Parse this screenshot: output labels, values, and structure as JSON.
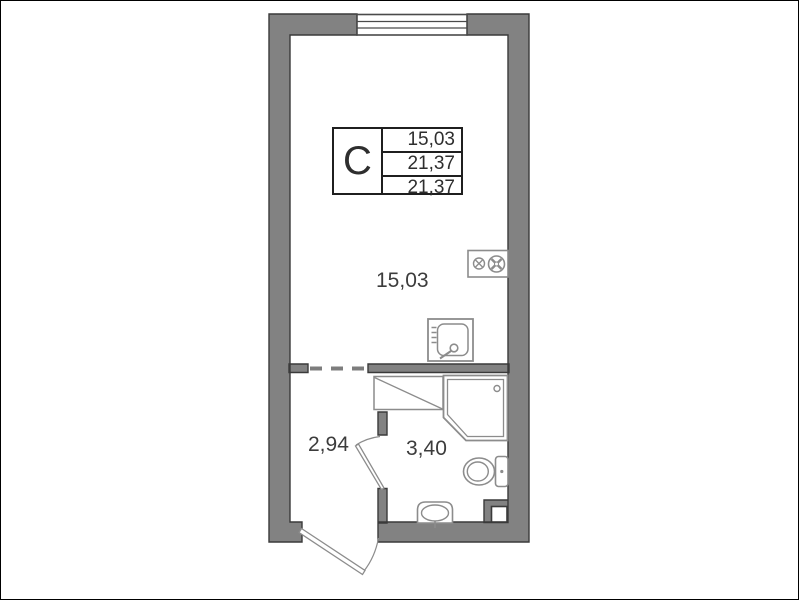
{
  "plan": {
    "title": "studio-apartment-floor-plan",
    "unit_table": {
      "type_label": "C",
      "values": [
        "15,03",
        "21,37",
        "21,37"
      ]
    },
    "rooms": {
      "living": {
        "area": "15,03"
      },
      "hall": {
        "area": "2,94"
      },
      "bath": {
        "area": "3,40"
      }
    },
    "fixtures": [
      "window",
      "stove",
      "kitchen-sink",
      "shower-cabin",
      "toilet",
      "washbasin",
      "vent-shaft",
      "entrance-door",
      "bathroom-door"
    ],
    "colors": {
      "wall": "#828282",
      "outline": "#3a3a3a",
      "fixture": "#8c8c8c",
      "table_border": "#1f1f1f",
      "text": "#3c3c3c",
      "background": "#ffffff"
    }
  }
}
